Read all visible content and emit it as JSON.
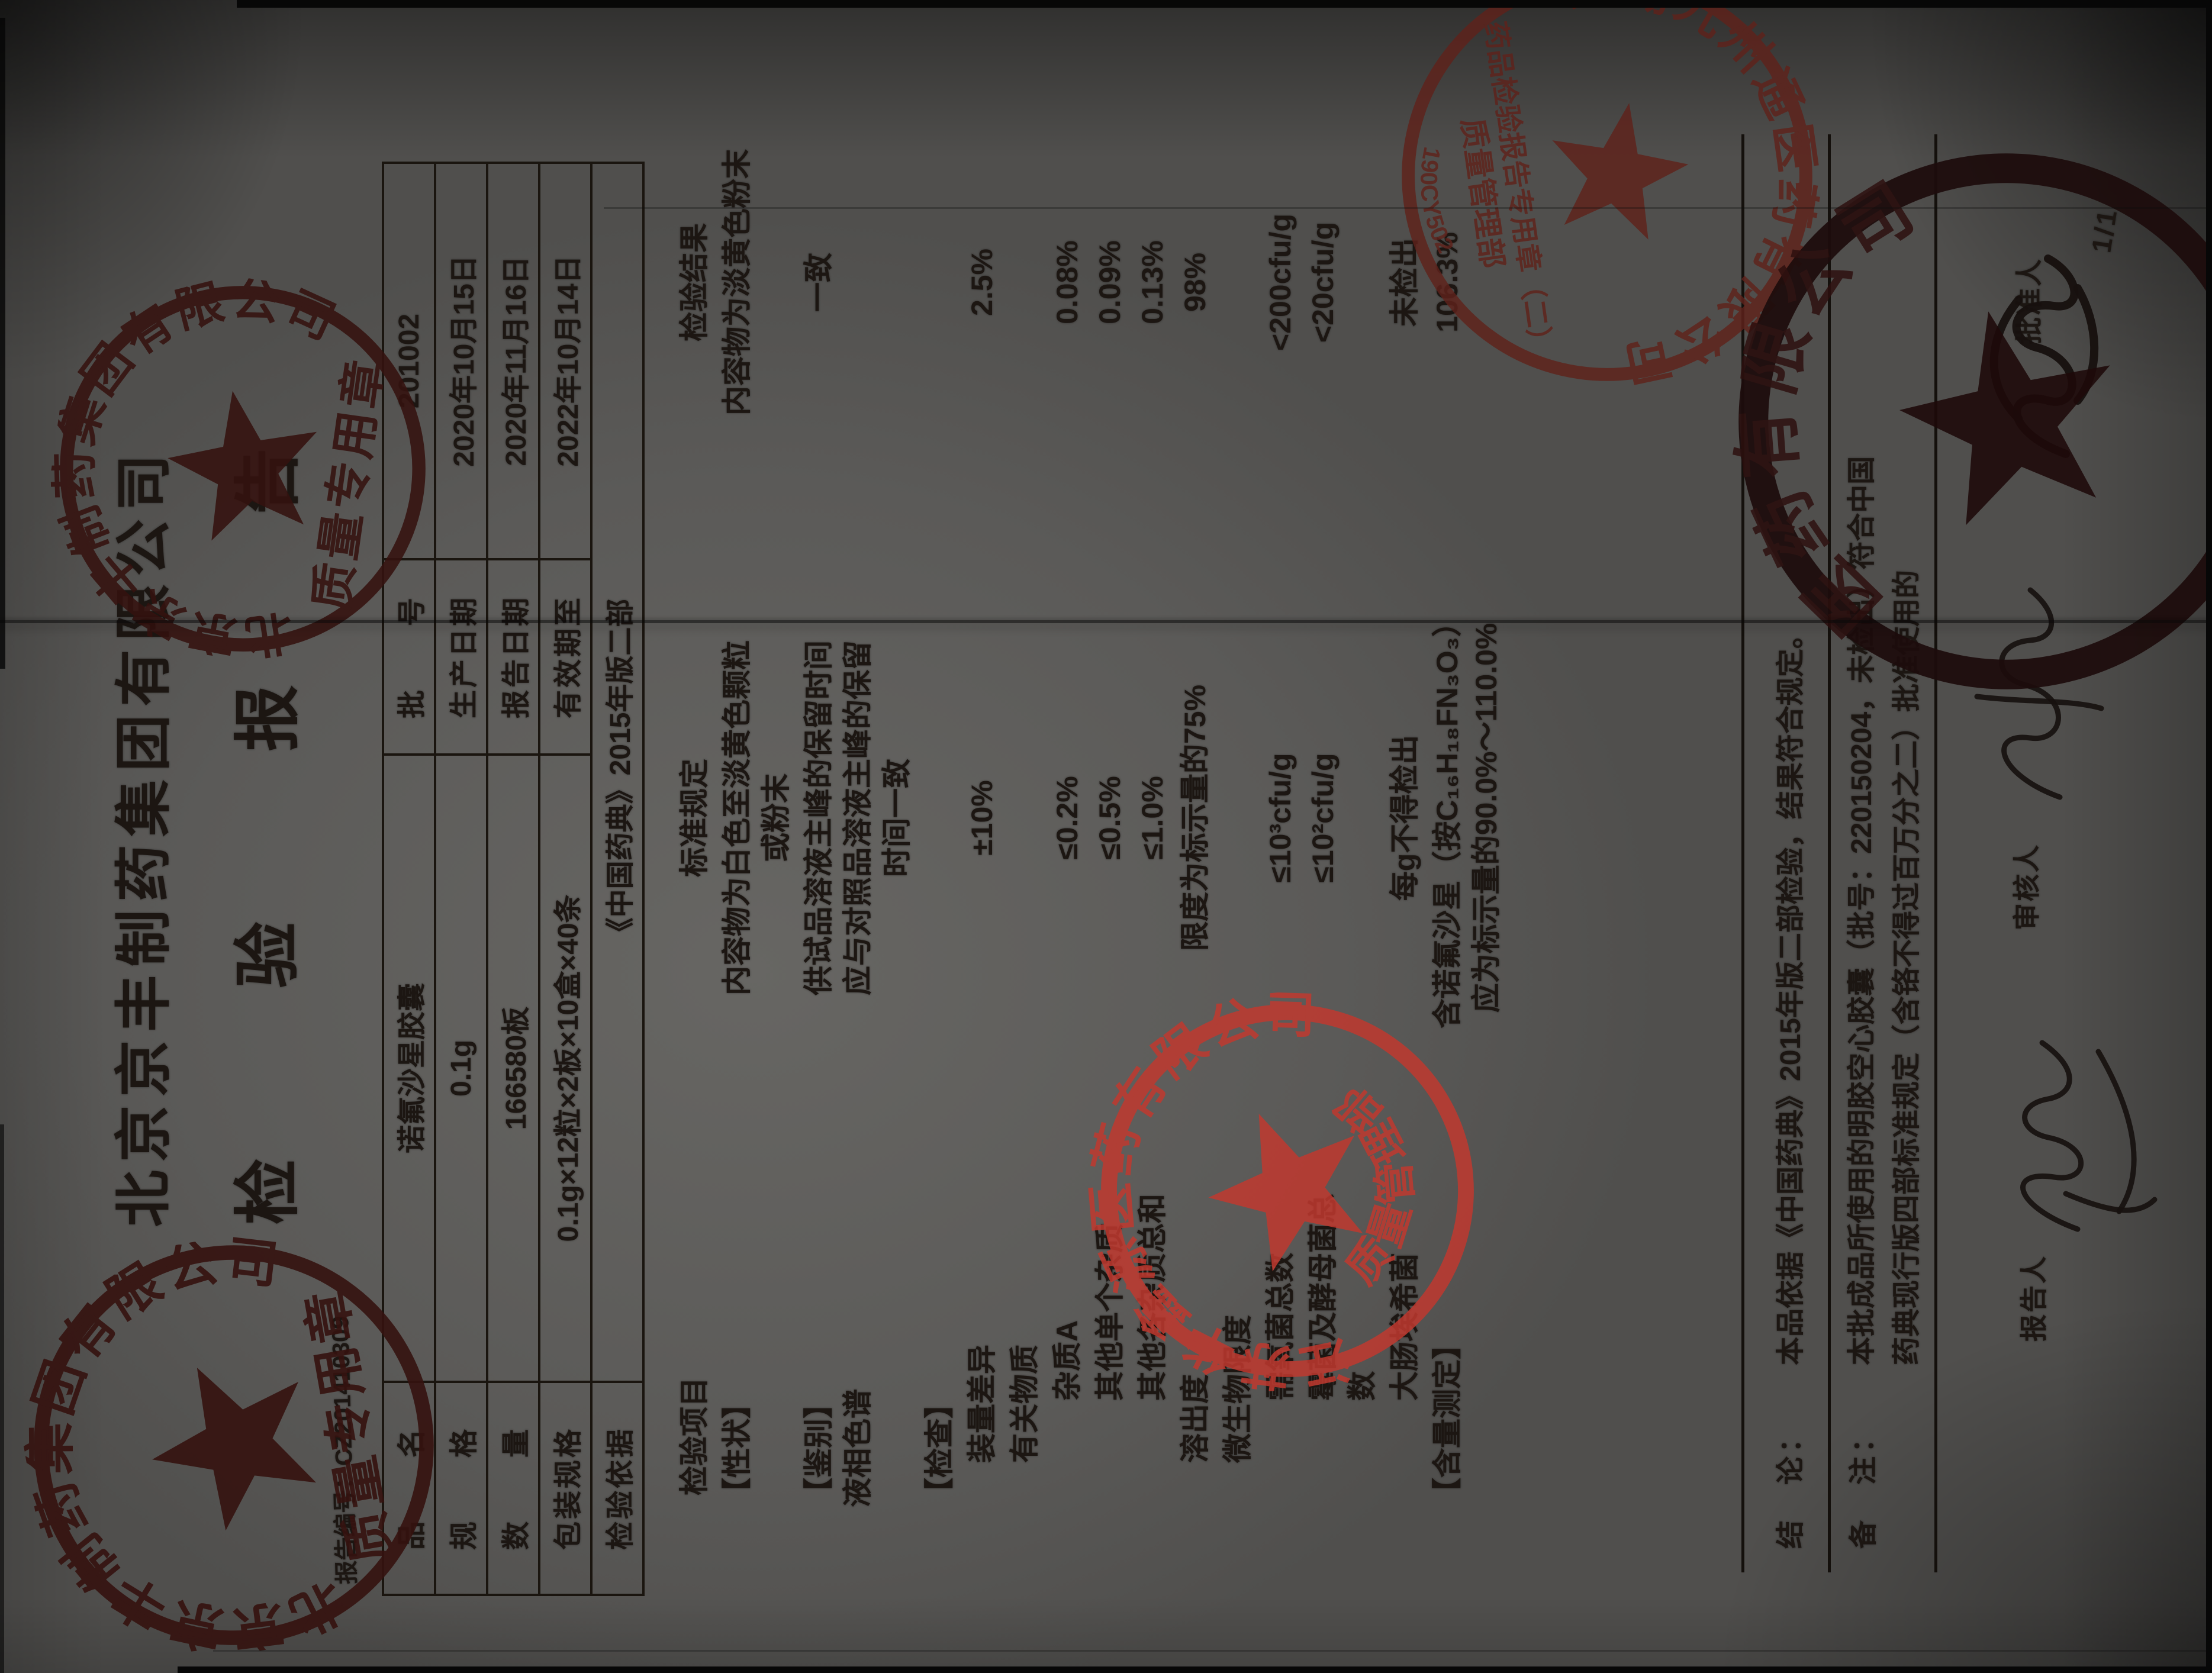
{
  "page": {
    "number": "1/1"
  },
  "header": {
    "company": "北京京丰制药集团有限公司",
    "title": "检　验　报　告",
    "report_no_label": "报告编号：",
    "report_no": "CZ201410309"
  },
  "info": {
    "rows": [
      {
        "label": "品　　名",
        "value": "诺氟沙星胶囊",
        "label2": "批　　号",
        "value2": "201002"
      },
      {
        "label": "规　　格",
        "value": "0.1g",
        "label2": "生产日期",
        "value2": "2020年10月15日"
      },
      {
        "label": "数　　量",
        "value": "166580板",
        "label2": "报告日期",
        "value2": "2020年11月16日"
      },
      {
        "label": "包装规格",
        "value": "0.1g×12粒×2板×10盒×40条",
        "label2": "有效期至",
        "value2": "2022年10月14日"
      },
      {
        "label": "检验依据",
        "value": "《中国药典》2015年版二部"
      }
    ]
  },
  "items": {
    "header": {
      "item": "检验项目",
      "standard": "标准规定",
      "result": "检验结果"
    },
    "rows": [
      {
        "item": [
          "【性状】"
        ],
        "std": [
          "内容物为白色至淡黄色颗粒",
          "或粉末"
        ],
        "res": [
          "内容物为淡黄色粉末"
        ]
      },
      {
        "item": [
          "【鉴别】",
          "液相色谱"
        ],
        "std": [
          "供试品溶液主峰的保留时间",
          "应与对照品溶液主峰的保留",
          "时间一致"
        ],
        "res": [
          "一致"
        ]
      },
      {
        "item": [
          "【检查】"
        ],
        "std": [],
        "res": []
      },
      {
        "item": [
          "装量差异"
        ],
        "std": [
          "±10%"
        ],
        "res": [
          "2.5%"
        ]
      },
      {
        "item": [
          "有关物质"
        ],
        "std": [],
        "res": []
      },
      {
        "item": [
          "杂质A"
        ],
        "std": [
          "≤0.2%"
        ],
        "res": [
          "0.08%"
        ]
      },
      {
        "item": [
          "其他单个杂质"
        ],
        "std": [
          "≤0.5%"
        ],
        "res": [
          "0.09%"
        ]
      },
      {
        "item": [
          "其他各杂质总和"
        ],
        "std": [
          "≤1.0%"
        ],
        "res": [
          "0.13%"
        ]
      },
      {
        "item": [
          "溶出度"
        ],
        "std": [
          "限度为标示量的75%"
        ],
        "res": [
          "98%"
        ]
      },
      {
        "item": [
          "微生物限度"
        ],
        "std": [],
        "res": []
      },
      {
        "item": [
          "需氧菌总数"
        ],
        "std": [
          "≤10³cfu/g"
        ],
        "res": [
          "<200cfu/g"
        ]
      },
      {
        "item": [
          "霉菌及酵母菌总数"
        ],
        "std": [
          "≤10²cfu/g"
        ],
        "res": [
          "<20cfu/g"
        ]
      },
      {
        "item": [
          "大肠埃希菌"
        ],
        "std": [
          "每g不得检出"
        ],
        "res": [
          "未检出"
        ]
      },
      {
        "item": [
          "【含量测定】"
        ],
        "std": [
          "含诺氟沙星（按C₁₆H₁₈FN₃O₃）",
          "应为标示量的90.0%～110.0%"
        ],
        "res": [
          "106.3%"
        ]
      }
    ]
  },
  "footer": {
    "conclusion_label": "结　论：",
    "conclusion": "本品依据《中国药典》2015年版二部检验，结果符合规定。",
    "remark_label": "备　注：",
    "remark_lines": [
      "本批成品所使用的明胶空心胶囊（批号：220150204，未检出）符合中国",
      "药典现行版四部标准规定（含铬不得过百万分之二）批准使用的"
    ],
    "reporter_label": "报告人",
    "reviewer_label": "审核人",
    "approver_label": "批准人"
  },
  "stamps": {
    "beijing": {
      "company": "北京京丰制药集团有限公司",
      "label": "质量专用章"
    },
    "huaxinyuan": {
      "company": "江苏华鑫源医药有限公司",
      "label": "质量管理部"
    },
    "wuxi": {
      "company": "无锡九州通医药有限公司",
      "line1": "药品检验报告专用章（二）",
      "line2": "质量管理部",
      "serial": "190CY502"
    },
    "dark": {
      "company": "医药有限公司"
    }
  }
}
